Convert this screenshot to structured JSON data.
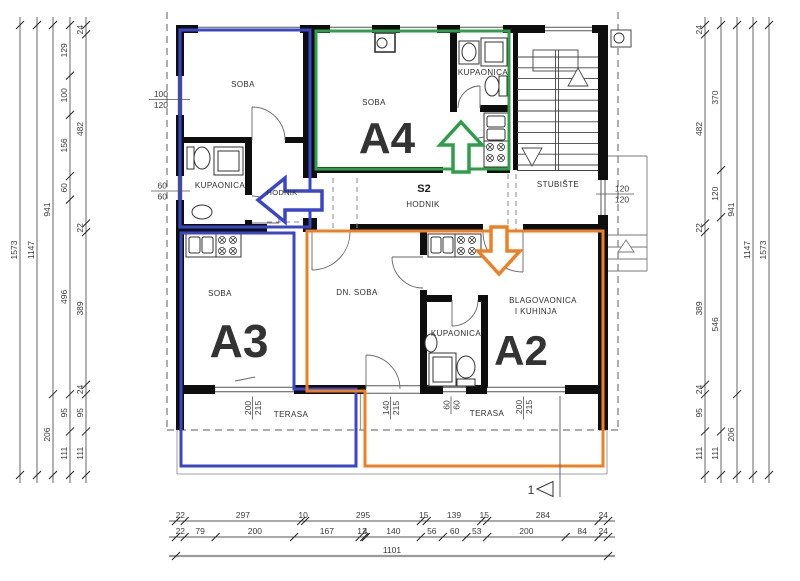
{
  "colors": {
    "blue": "#3a46c9",
    "green": "#2f9e48",
    "orange": "#ee8023",
    "wall": "#0e0e0e",
    "thin": "#555",
    "dash": "#7a7a7a",
    "gray": "#a8a8a8",
    "dimline": "#555"
  },
  "apartments": {
    "a2": "A2",
    "a3": "A3",
    "a4": "A4"
  },
  "rooms": {
    "soba_tl": "SOBA",
    "kupaonica_a3": "KUPAONICA",
    "hodnik_a3": "HODNIK",
    "soba_a4": "SOBA",
    "kupaonica_a4": "KUPAONICA",
    "s2": "S2",
    "hodnik_main": "HODNIK",
    "stubiste": "STUBIŠTE",
    "soba_a3": "SOBA",
    "dn_soba": "DN. SOBA",
    "kupaonica_a2": "KUPAONICA",
    "blagovaonica_1": "BLAGOVAONICA",
    "blagovaonica_2": "I KUHINJA",
    "terasa_left": "TERASA",
    "terasa_right": "TERASA"
  },
  "dims": {
    "left_chains": [
      [
        1573
      ],
      [
        1147
      ],
      [
        941,
        206
      ],
      [
        129,
        100,
        156,
        60,
        496,
        95,
        111
      ],
      [
        24,
        482,
        22,
        389,
        24,
        95,
        111
      ]
    ],
    "right_chains": [
      [
        24,
        482,
        22,
        389,
        24,
        95,
        111
      ],
      [
        370,
        120,
        546,
        111
      ],
      [
        941,
        206
      ],
      [
        1147
      ],
      [
        1573
      ]
    ],
    "bottom_rows": [
      [
        22,
        297,
        10,
        295,
        15,
        139,
        15,
        284,
        24
      ],
      [
        22,
        79,
        200,
        167,
        12,
        4,
        140,
        56,
        60,
        53,
        200,
        84,
        24
      ],
      [
        1101
      ]
    ],
    "openings": {
      "left_upper": [
        "100",
        "120"
      ],
      "left_lower": [
        "60",
        "60"
      ],
      "stair_window": [
        "120",
        "120"
      ],
      "terasa_a3": [
        "200",
        "215"
      ],
      "door_dn": [
        "140",
        "215"
      ],
      "bath_a2": [
        "60",
        "60"
      ],
      "terasa_a2": [
        "200",
        "215"
      ]
    }
  },
  "section_marker": "1"
}
